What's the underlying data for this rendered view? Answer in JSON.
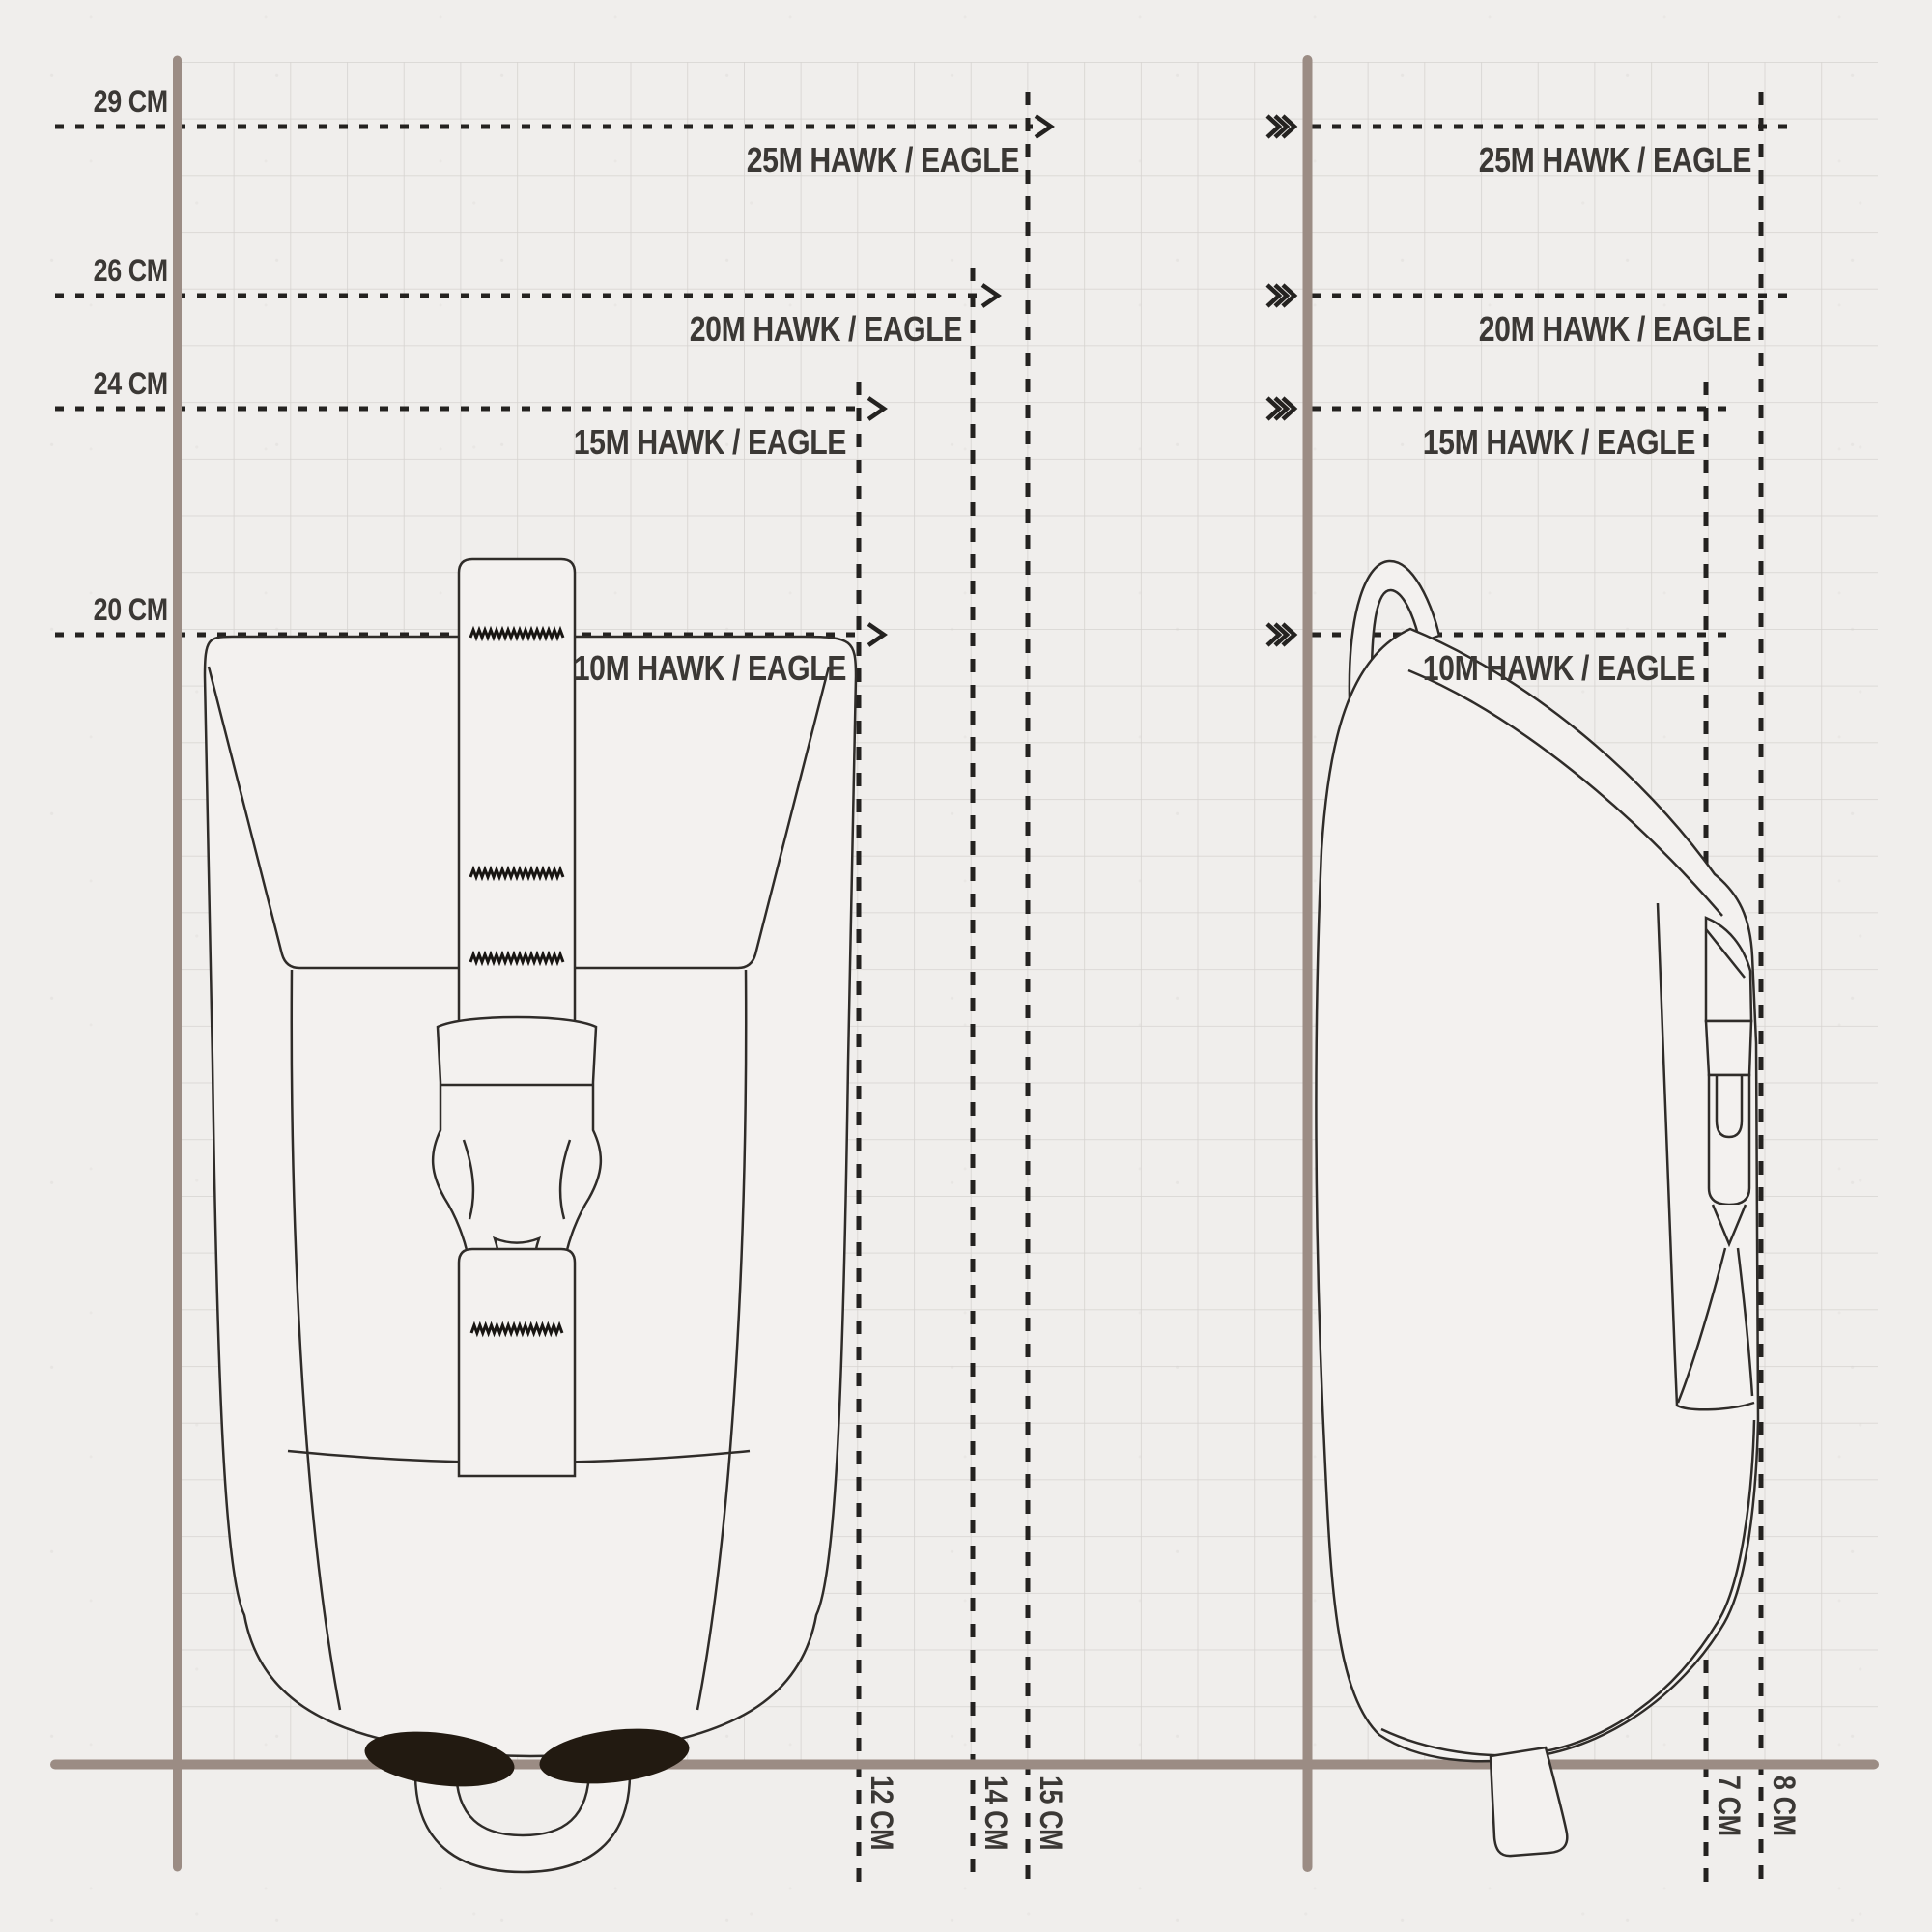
{
  "colors": {
    "background": "#f0eeec",
    "grid": "#d6d3d0",
    "axis": "#9b8c84",
    "ink": "#3b3835",
    "outline": "#2f2c29",
    "keeper": "#221a11"
  },
  "measurements": {
    "heights": [
      {
        "height": "29 CM",
        "size": "25M HAWK / EAGLE"
      },
      {
        "height": "26 CM",
        "size": "20M HAWK / EAGLE"
      },
      {
        "height": "24 CM",
        "size": "15M HAWK / EAGLE"
      },
      {
        "height": "20 CM",
        "size": "10M HAWK / EAGLE"
      }
    ],
    "side_sizes": [
      "25M HAWK / EAGLE",
      "20M HAWK / EAGLE",
      "15M HAWK / EAGLE",
      "10M HAWK / EAGLE"
    ],
    "front_widths": [
      "12 CM",
      "14 CM",
      "15 CM"
    ],
    "side_depths": [
      "7 CM",
      "8 CM"
    ]
  }
}
